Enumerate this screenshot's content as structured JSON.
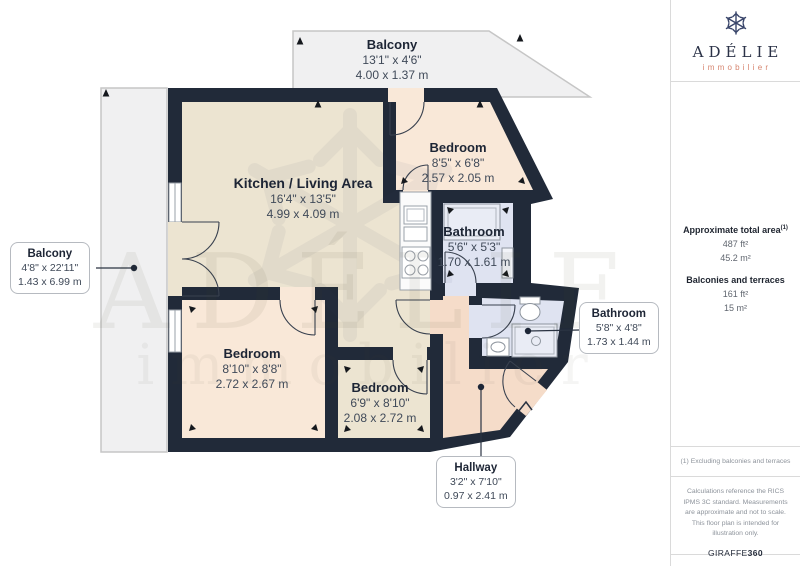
{
  "rooms": {
    "balcony_top": {
      "name": "Balcony",
      "imperial": "13'1\" x 4'6\"",
      "metric": "4.00 x 1.37 m"
    },
    "balcony_left": {
      "name": "Balcony",
      "imperial": "4'8\" x 22'11\"",
      "metric": "1.43 x 6.99 m"
    },
    "kitchen_living": {
      "name": "Kitchen / Living Area",
      "imperial": "16'4\" x 13'5\"",
      "metric": "4.99 x 4.09 m"
    },
    "bedroom_top": {
      "name": "Bedroom",
      "imperial": "8'5\" x 6'8\"",
      "metric": "2.57 x 2.05 m"
    },
    "bathroom_main": {
      "name": "Bathroom",
      "imperial": "5'6\" x 5'3\"",
      "metric": "1.70 x 1.61 m"
    },
    "bathroom_ensuite": {
      "name": "Bathroom",
      "imperial": "5'8\" x 4'8\"",
      "metric": "1.73 x 1.44 m"
    },
    "bedroom_left": {
      "name": "Bedroom",
      "imperial": "8'10\" x 8'8\"",
      "metric": "2.72 x 2.67 m"
    },
    "bedroom_middle": {
      "name": "Bedroom",
      "imperial": "6'9\" x 8'10\"",
      "metric": "2.08 x 2.72 m"
    },
    "hallway": {
      "name": "Hallway",
      "imperial": "3'2\" x 7'10\"",
      "metric": "0.97 x 2.41 m"
    }
  },
  "sidebar": {
    "logo": {
      "icon": "snowflake-icon",
      "title": "ADÉLIE",
      "subtitle": "immobilier"
    },
    "areas": {
      "total_label": "Approximate total area",
      "total_note_ref": "(1)",
      "total_ft": "487 ft²",
      "total_m": "45.2 m²",
      "balconies_label": "Balconies and terraces",
      "balconies_ft": "161 ft²",
      "balconies_m": "15 m²"
    },
    "footnote": "(1) Excluding balconies and terraces",
    "disclaimer": "Calculations reference the RICS IPMS 3C standard. Measurements are approximate and not to scale. This floor plan is intended for illustration only.",
    "credit": {
      "name": "GIRAFFE",
      "suffix": "360"
    }
  },
  "colors": {
    "wall": "#212a39",
    "kitchen_floor": "#ece4d1",
    "bedroom_floor": "#f9e8d8",
    "bathroom_floor": "#dfe3f1",
    "hallway_floor": "#f5dcc9",
    "balcony_floor": "#f0f0f1",
    "accent_coral": "#d6846e",
    "text_navy": "#1d2535"
  }
}
